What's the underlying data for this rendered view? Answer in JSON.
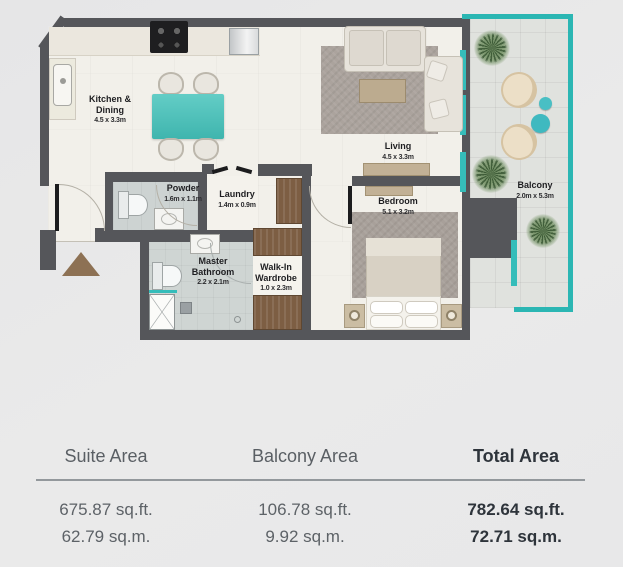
{
  "plan": {
    "rooms": {
      "kitchen": {
        "name": "Kitchen & Dining",
        "dims": "4.5 x 3.3m"
      },
      "living": {
        "name": "Living",
        "dims": "4.5 x 3.3m"
      },
      "bedroom": {
        "name": "Bedroom",
        "dims": "5.1 x 3.2m"
      },
      "balcony": {
        "name": "Balcony",
        "dims": "2.0m x 5.3m"
      },
      "powder": {
        "name": "Powder",
        "dims": "1.6m x 1.1m"
      },
      "laundry": {
        "name": "Laundry",
        "dims": "1.4m x 0.9m"
      },
      "master_bathroom": {
        "name": "Master Bathroom",
        "dims": "2.2 x 2.1m"
      },
      "walkin_wardrobe": {
        "name": "Walk-In Wardrobe",
        "dims": "1.0 x 2.3m"
      }
    },
    "colors": {
      "wall": "#55565a",
      "glass_teal": "#2bb6b3",
      "table_teal": "#4cc5bf",
      "wood": "#7d5e43"
    }
  },
  "area_table": {
    "columns": [
      {
        "header": "Suite Area",
        "sqft": "675.87 sq.ft.",
        "sqm": "62.79 sq.m.",
        "emphasis": false
      },
      {
        "header": "Balcony Area",
        "sqft": "106.78 sq.ft.",
        "sqm": "9.92 sq.m.",
        "emphasis": false
      },
      {
        "header": "Total Area",
        "sqft": "782.64 sq.ft.",
        "sqm": "72.71 sq.m.",
        "emphasis": true
      }
    ]
  }
}
